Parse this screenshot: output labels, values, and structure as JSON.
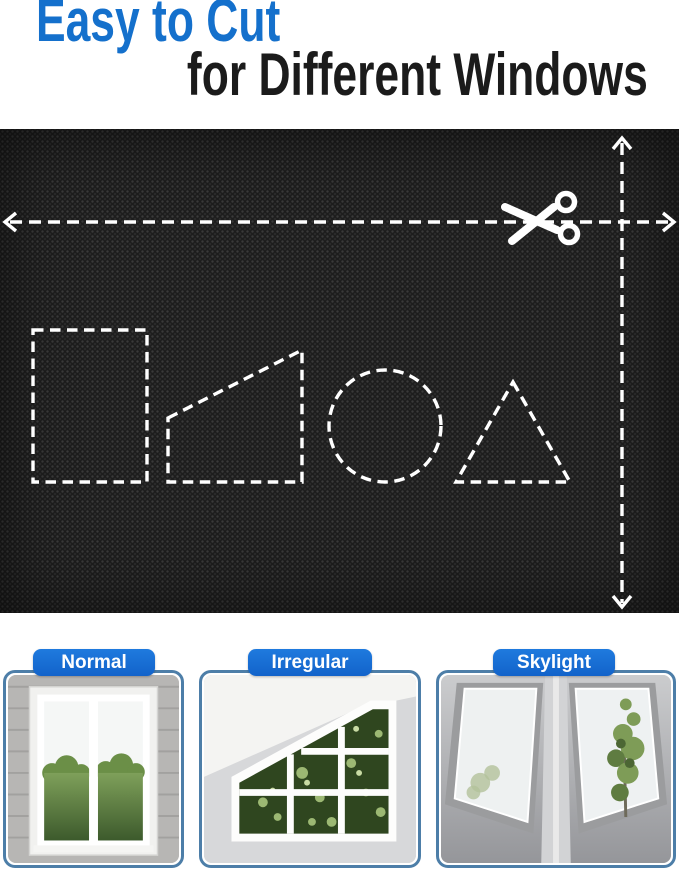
{
  "title": {
    "line1": "Easy to Cut",
    "line2": "for Different Windows"
  },
  "fabric_panel": {
    "icon": "scissors-icon",
    "guide_lines": [
      "horizontal-dashed-cut-line",
      "vertical-dashed-cut-line"
    ],
    "cut_shapes": [
      "rectangle",
      "right-trapezoid",
      "circle",
      "triangle"
    ]
  },
  "cards": [
    {
      "label": "Normal"
    },
    {
      "label": "Irregular"
    },
    {
      "label": "Skylight"
    }
  ],
  "colors": {
    "accent_blue": "#1470cc",
    "pill_blue": "#1263ca",
    "card_border": "#4d7ea8",
    "title_dark": "#1b1b1b",
    "fabric_black": "#1d1d1d",
    "dash_white": "#ffffff"
  }
}
